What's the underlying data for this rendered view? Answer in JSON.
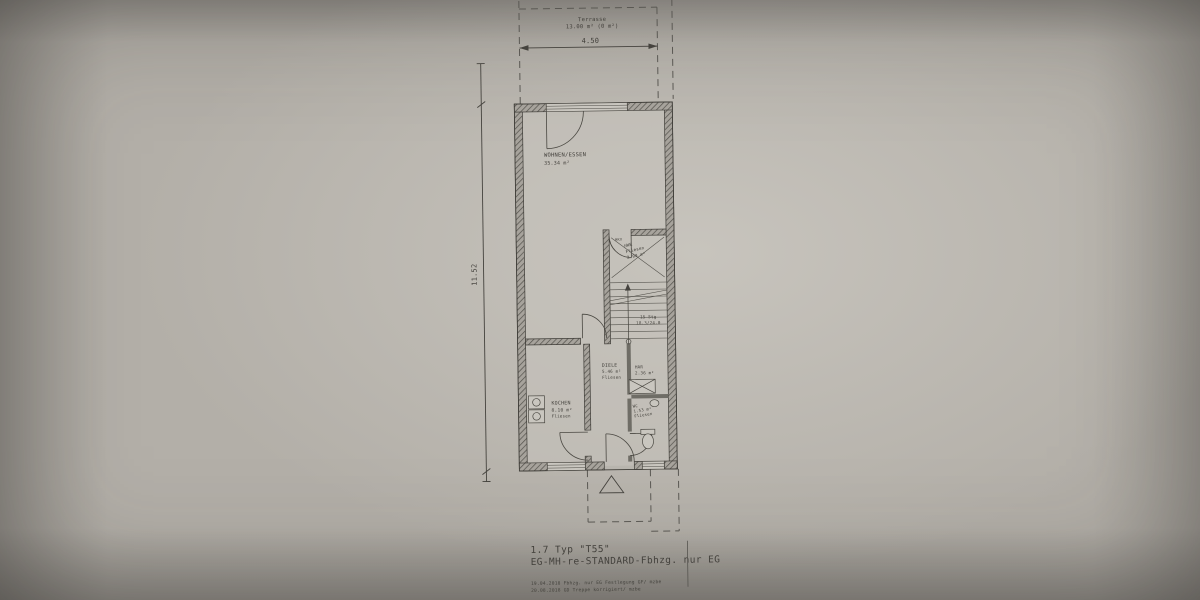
{
  "colors": {
    "paper": "#b3afa8",
    "ink": "#44423d",
    "wall_hatch": "#53514b"
  },
  "terrace": {
    "name": "Terrasse",
    "area": "13.00 m² (0 m²)"
  },
  "dimensions": {
    "width": "4.50",
    "height": "11.52"
  },
  "rooms": {
    "living": {
      "name": "WOHNEN/ESSEN",
      "area": "35.34 m²"
    },
    "kitchen": {
      "name": "KOCHEN",
      "area": "8.10 m²",
      "floor": "Fliesen"
    },
    "diele": {
      "name": "DIELE",
      "area": "5.46 m²",
      "floor": "Fliesen"
    },
    "har": {
      "name": "HAR",
      "area": "2.36 m²"
    },
    "wc": {
      "name": "WC",
      "area": "1.53 m²",
      "floor": "Fliesen"
    },
    "hwr": {
      "name": "HWR",
      "area": "2.90 m²",
      "floor": "Fliesen",
      "note": "HKV"
    }
  },
  "stairs": {
    "count": "15 Stg",
    "ratio": "18.3/24.0"
  },
  "title_block": {
    "line1": "1.7 Typ \"T55\"",
    "line2": "EG-MH-re-STANDARD-Fbhzg. nur EG",
    "revisions": [
      "19.04.2018 Fbhzg. nur EG Festlegung GF/ mzbe",
      "20.08.2018 GD Treppe korrigiert/ mzbe"
    ]
  }
}
